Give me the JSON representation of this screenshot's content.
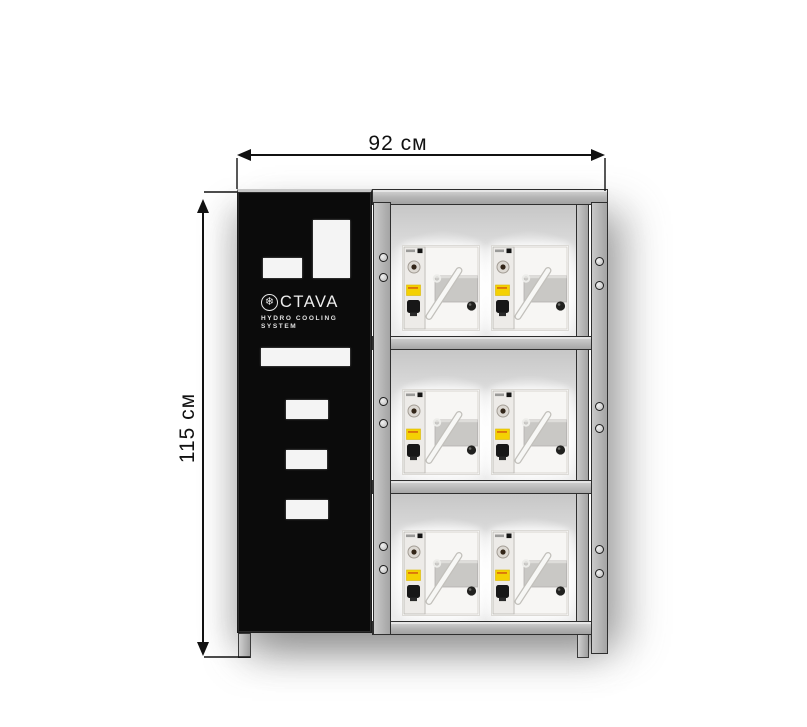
{
  "dimensions": {
    "width_label": "92 см",
    "height_label": "115 см"
  },
  "panel": {
    "brand_text": "CTAVA",
    "brand_icon": "snowflake-in-circle",
    "subtitle_line1": "HYDRO COOLING",
    "subtitle_line2": "SYSTEM"
  },
  "rack": {
    "shelf_count": 3,
    "machines_per_shelf": 2,
    "machine_description": "hydro-cooling-unit"
  },
  "colors": {
    "panel_black": "#0b0b0b",
    "frame_gray": "#b3b3b3",
    "label_yellow": "#f4d103",
    "dimension_line": "#111111"
  }
}
